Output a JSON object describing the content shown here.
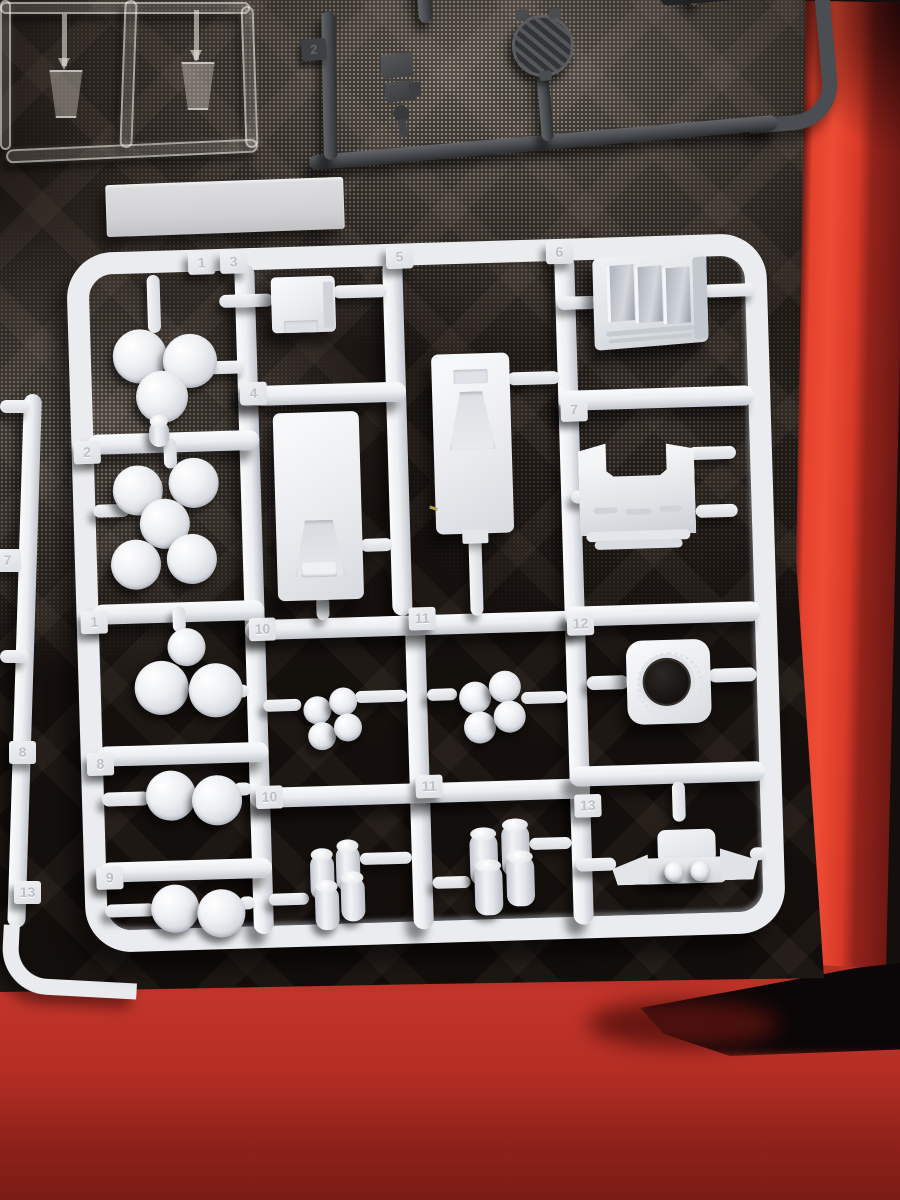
{
  "scene": {
    "subject": "plastic model kit sprues on black hobby mat with red backdrop",
    "colors": {
      "white_plastic": "#e9ebee",
      "dark_plastic": "#47494d",
      "clear_plastic": "#d8d4cc",
      "mat_black": "#16110d",
      "red_bright": "#e4422e",
      "red_dark": "#7c1d16",
      "gray_part": "#d6d5d7"
    }
  },
  "white_sprue": {
    "tabs": {
      "top": [
        "1",
        "3",
        "5",
        "6"
      ],
      "left": [
        "2",
        "1",
        "8",
        "9"
      ],
      "middle": [
        "4",
        "10",
        "11",
        "10",
        "11"
      ],
      "right": [
        "7",
        "12",
        "13"
      ]
    },
    "parts": [
      {
        "number": "1",
        "shape": "three-cylinder-cluster"
      },
      {
        "number": "2",
        "shape": "five-cylinder-cluster"
      },
      {
        "number": "3",
        "shape": "small-stepped-block"
      },
      {
        "number": "4",
        "shape": "tall-box-trapezoid-recess"
      },
      {
        "number": "5",
        "shape": "tall-box-trapezoid-recess"
      },
      {
        "number": "6",
        "shape": "louvered-grille-block"
      },
      {
        "number": "7",
        "shape": "notched-cowl-ridged-base"
      },
      {
        "number": "8",
        "shape": "two-cylinder-pair"
      },
      {
        "number": "9",
        "shape": "two-cylinder-pair"
      },
      {
        "number": "10",
        "shape": "four-cylinder-cluster"
      },
      {
        "number": "11",
        "shape": "four-cylinder-cluster"
      },
      {
        "number": "12",
        "shape": "block-with-round-bore"
      },
      {
        "number": "13",
        "shape": "front-panel-twin-lights"
      }
    ]
  },
  "left_sprue": {
    "tabs": [
      "7",
      "8",
      "13"
    ]
  },
  "dark_sprue": {
    "tabs": [
      "2"
    ],
    "parts": [
      {
        "shape": "hatched-disc"
      },
      {
        "shape": "small-bracket"
      }
    ]
  },
  "clear_sprue": {
    "parts": [
      {
        "shape": "trapezoid-window"
      },
      {
        "shape": "trapezoid-window"
      }
    ]
  },
  "loose_part": {
    "shape": "flat-gray-strip"
  }
}
